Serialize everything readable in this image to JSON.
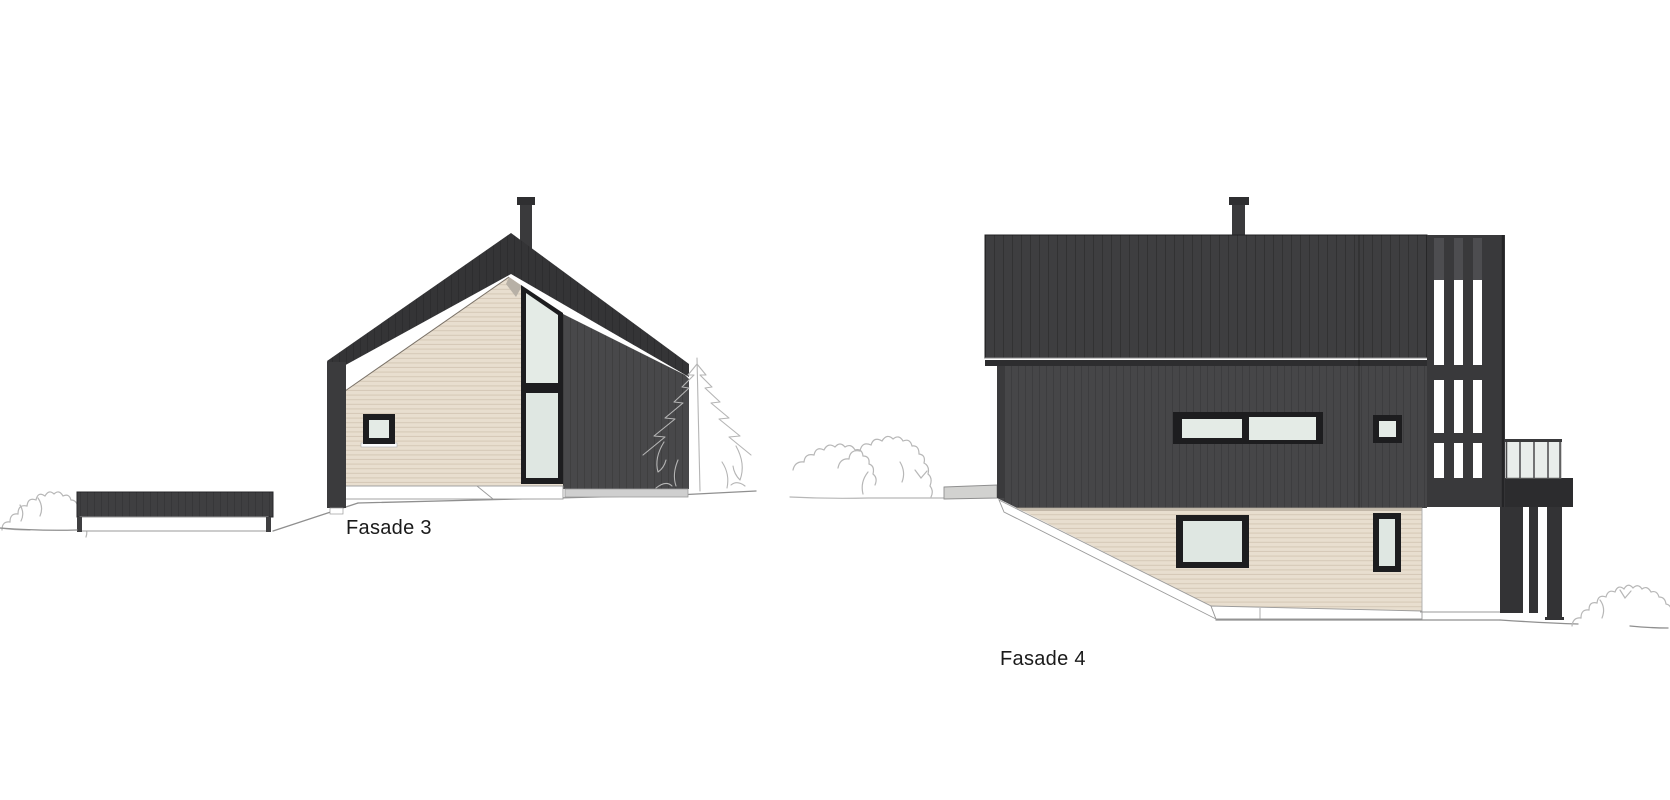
{
  "sheet": {
    "type": "architectural-elevation-sheet",
    "background": "#ffffff"
  },
  "drawings": [
    {
      "id": "fasade-3",
      "label": "Fasade 3"
    },
    {
      "id": "fasade-4",
      "label": "Fasade 4"
    }
  ],
  "palette": {
    "dark_roof": "#343436",
    "dark_cladding_wall": "#48484a",
    "dark_cladding_wall_2": "#464648",
    "slat_screen": "#39393b",
    "balcony_slab": "#2c2c2e",
    "beige_cladding": "#e8decf",
    "beige_siding_line": "#d5c8b6",
    "window_frame": "#1d1d1f",
    "window_glass": "#e4ebe6",
    "window_glass_lower": "#dfe7e2",
    "foundation_white": "#ffffff",
    "foundation_gray": "#cfcfcf",
    "concrete_step": "#d2d2d0",
    "ground_line": "#8f8f8f",
    "vegetation_sketch": "#b7b7b7",
    "label_text": "#1a1a1a"
  }
}
